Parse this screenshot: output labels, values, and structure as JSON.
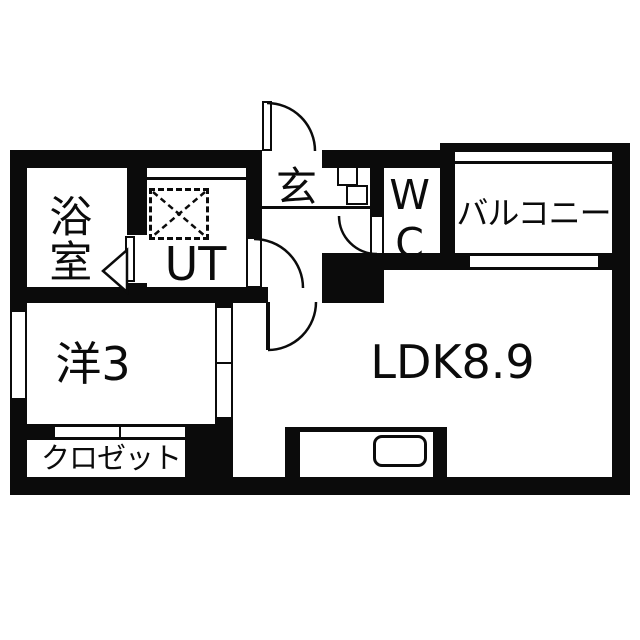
{
  "plan": {
    "bg_color": "#ffffff",
    "wall_color": "#0b0b0b",
    "rooms": {
      "bathroom": "浴室",
      "utility": "UT",
      "entrance": "玄",
      "toilet": "WC",
      "balcony": "バルコニー",
      "western_room": "洋3",
      "ldk": "LDK8.9",
      "closet": "クロゼット"
    }
  }
}
